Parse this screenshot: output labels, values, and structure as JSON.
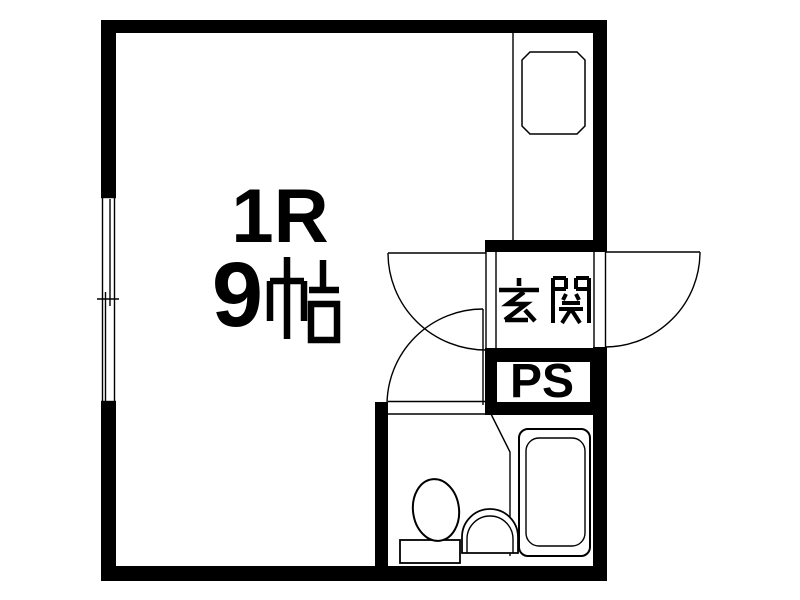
{
  "floor_plan": {
    "main_room": {
      "type_label": "1R",
      "size_label": "9帖"
    },
    "entrance": {
      "label": "玄関"
    },
    "pipe_space": {
      "label": "PS"
    },
    "kitchen": {
      "fixture": "sink"
    },
    "bathroom": {
      "fixtures": [
        "toilet",
        "washbasin",
        "bathtub"
      ]
    },
    "doors": [
      "room-entry-door",
      "front-door",
      "bathroom-door"
    ],
    "window": "sliding-window-left-wall",
    "colors": {
      "wall": "#000000",
      "background": "#ffffff",
      "line": "#000000"
    }
  }
}
